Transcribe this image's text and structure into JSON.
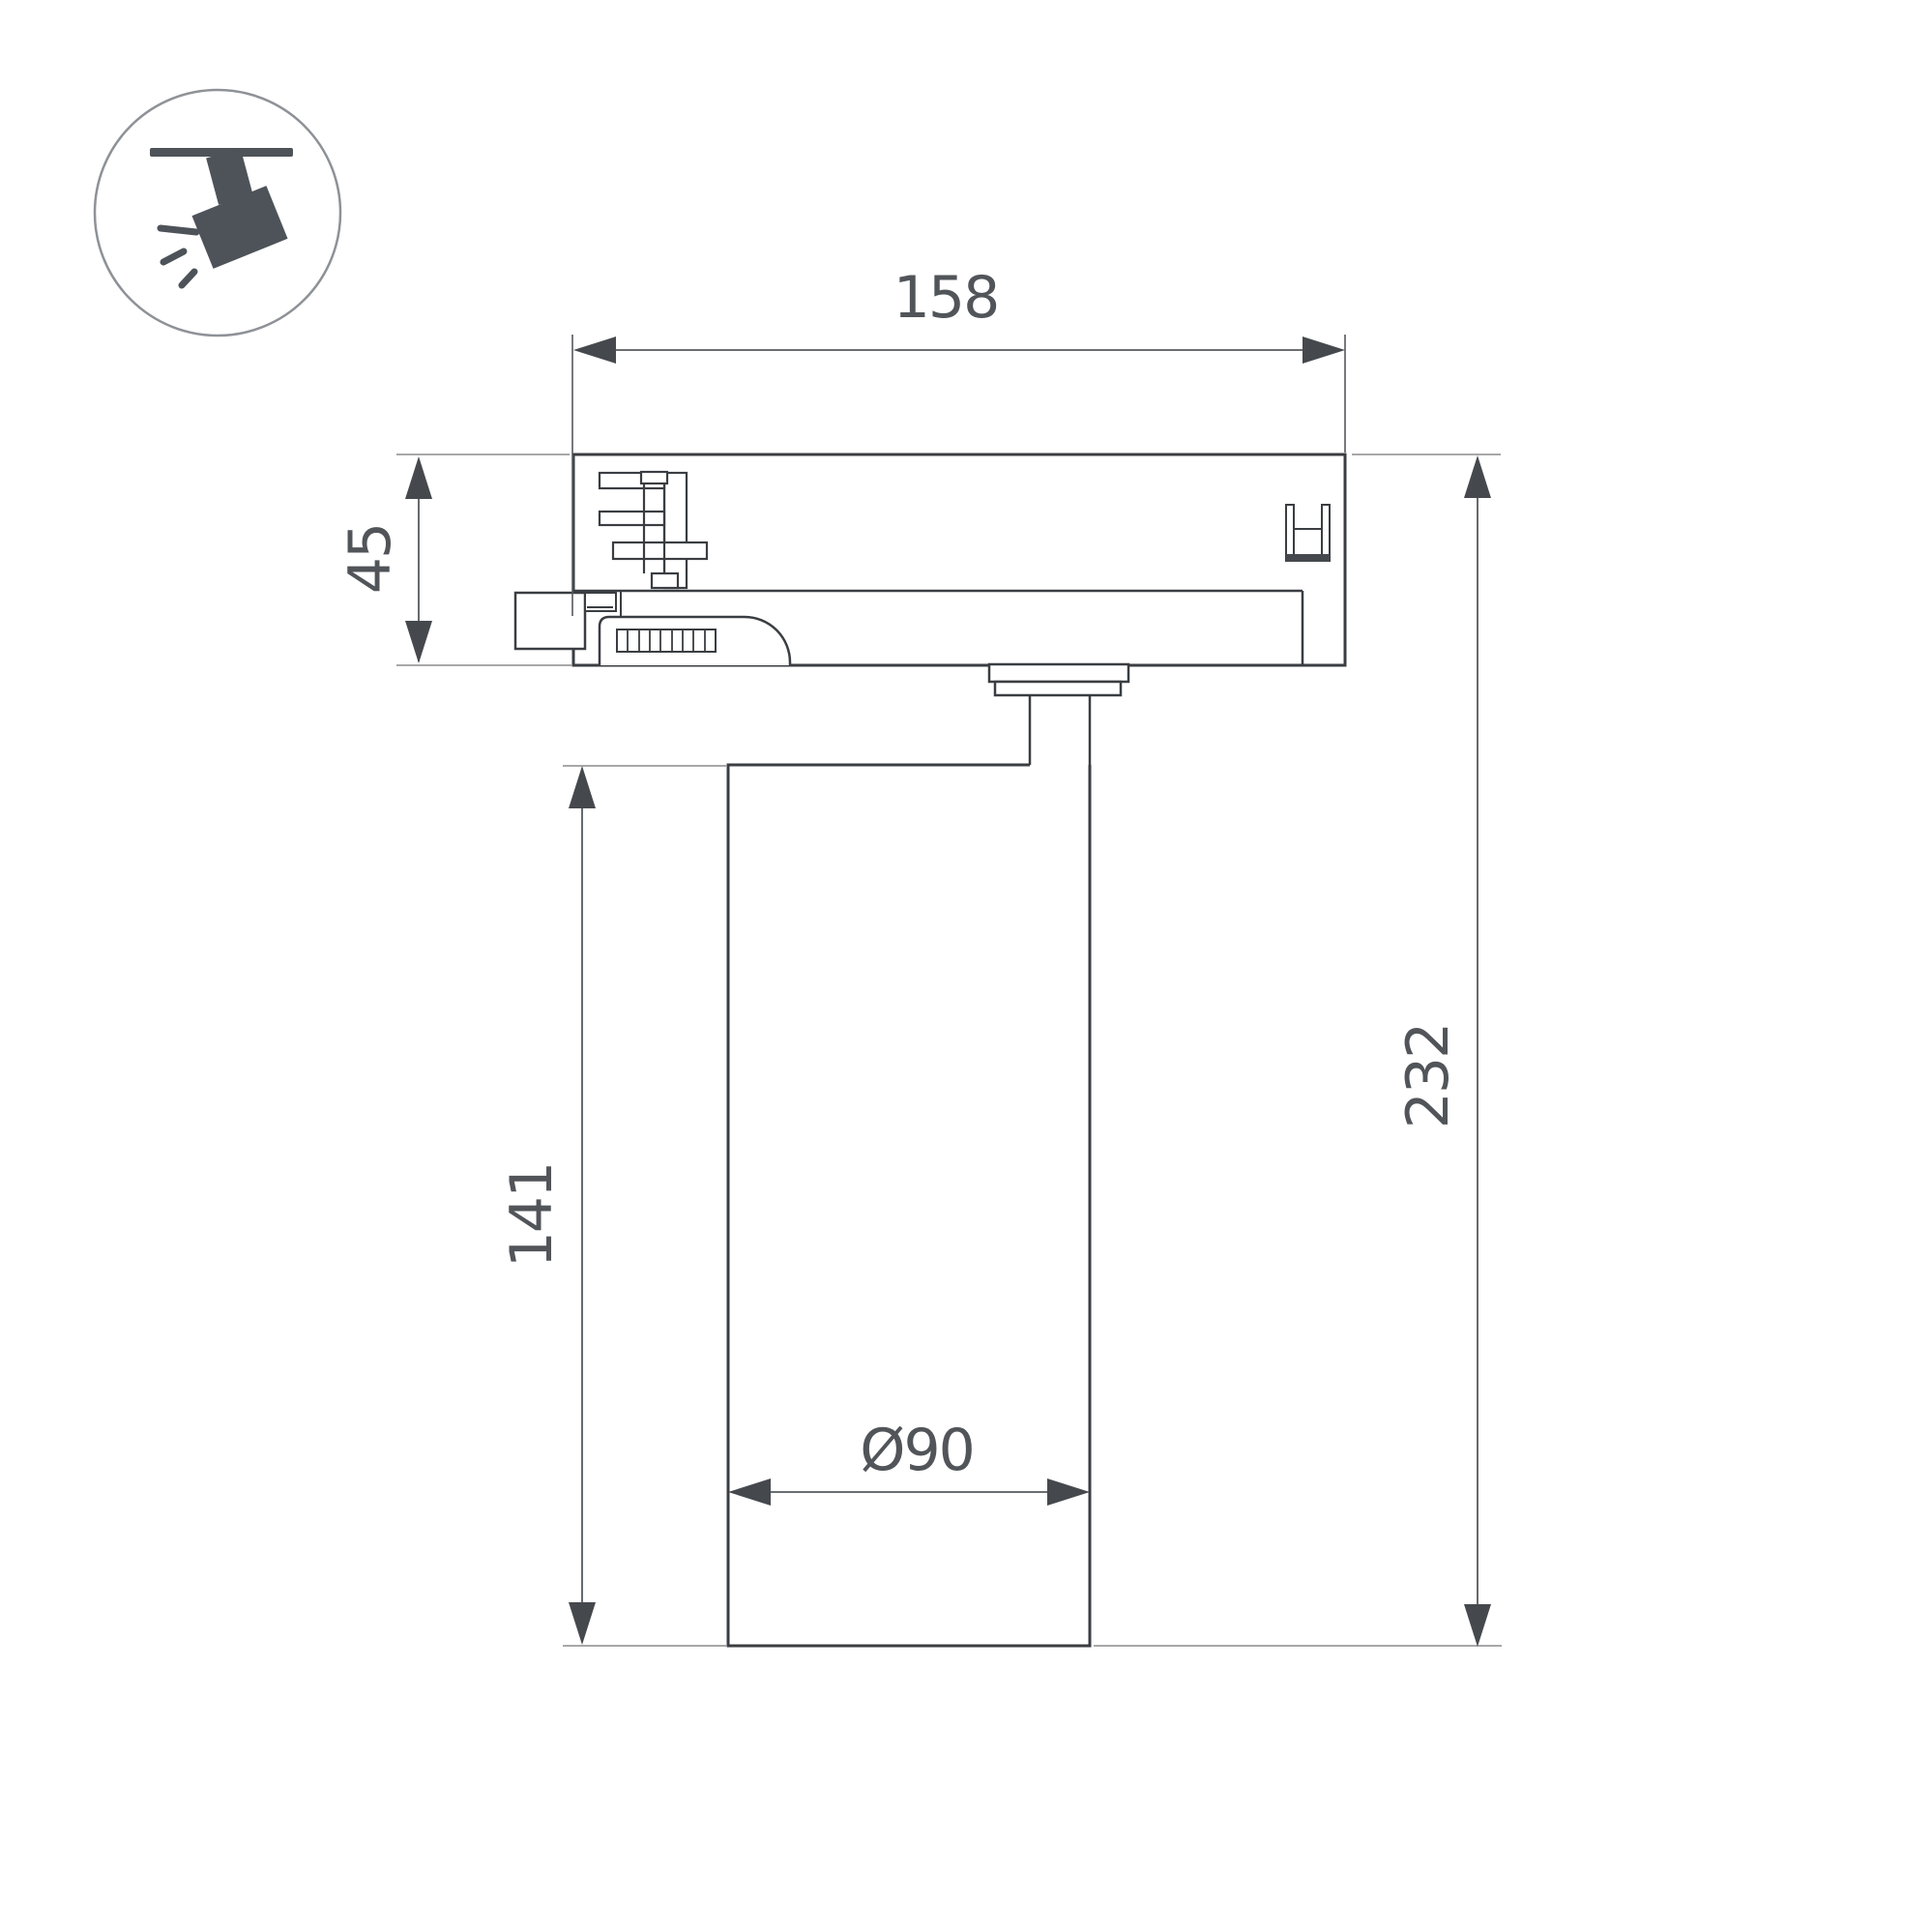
{
  "page": {
    "background": "#ffffff"
  },
  "icon": {
    "name": "track-spotlight",
    "color": "#4d5359",
    "ring_color": "#8e9297"
  },
  "dims": {
    "width": {
      "label": "158"
    },
    "adapter_height": {
      "label": "45"
    },
    "body_height": {
      "label": "141"
    },
    "total_height": {
      "label": "232"
    },
    "diameter": {
      "label": "Ø90"
    }
  },
  "colors": {
    "outline": "#3a3e42",
    "detail": "#3f4347",
    "dim_line": "#55595d",
    "arrow": "#45494d",
    "extension": "#a8a8a8",
    "label_text": "#515559"
  }
}
